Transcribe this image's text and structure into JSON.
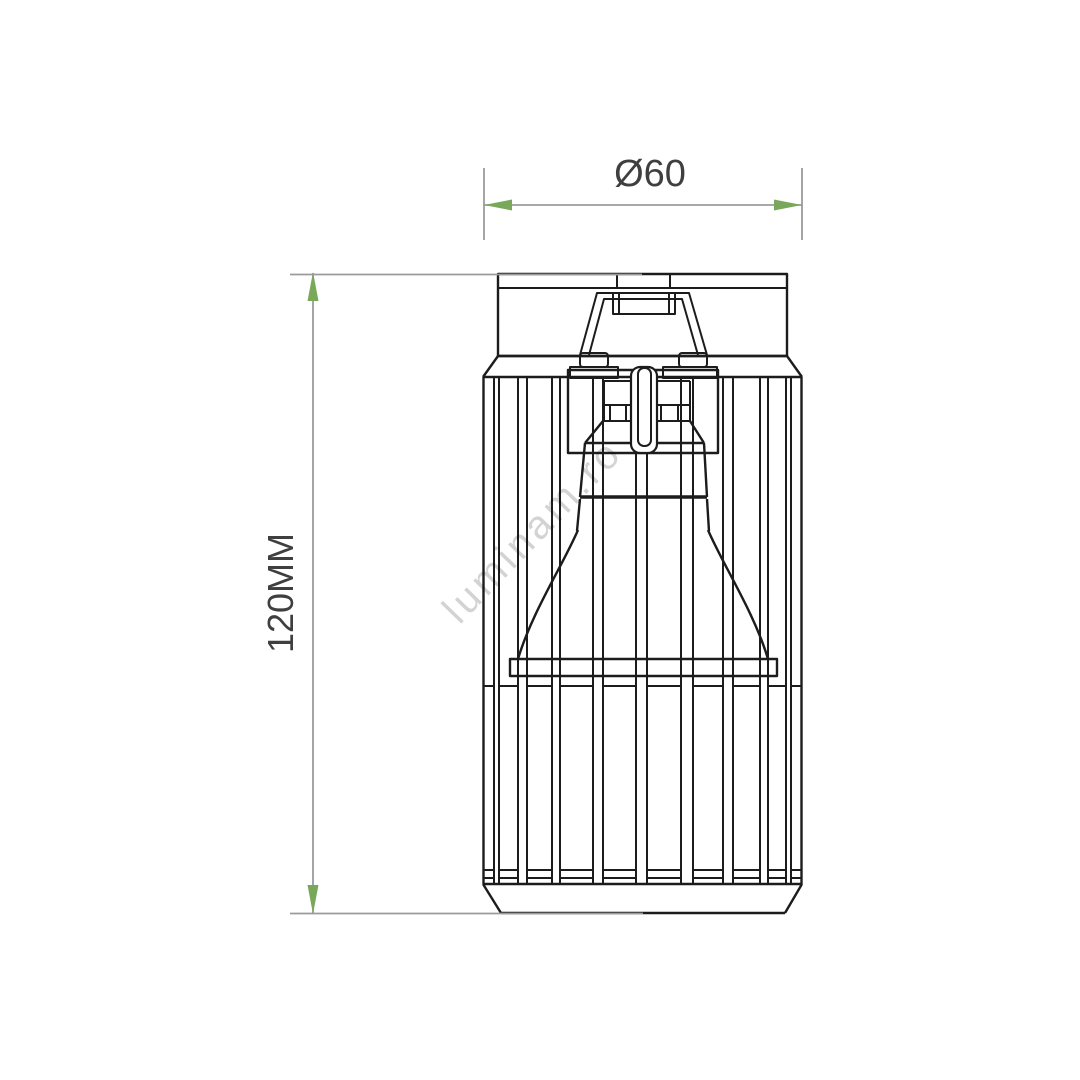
{
  "drawing": {
    "type": "technical-dimension-drawing",
    "subject": "cage-spotlight-ceiling-fixture-front-view",
    "dimensions": {
      "diameter": {
        "label": "Ø60",
        "value_mm": 60,
        "orientation": "horizontal"
      },
      "height": {
        "label": "120MM",
        "value_mm": 120,
        "orientation": "vertical"
      }
    },
    "watermark": {
      "text": "luminam.ro"
    },
    "colors": {
      "ink": "#1c1c1c",
      "dimension_gray": "#9b9b9b",
      "arrow_green": "#7aa85a",
      "text": "#3f3f3f",
      "watermark": "#a8a8a8",
      "background": "#ffffff"
    }
  }
}
